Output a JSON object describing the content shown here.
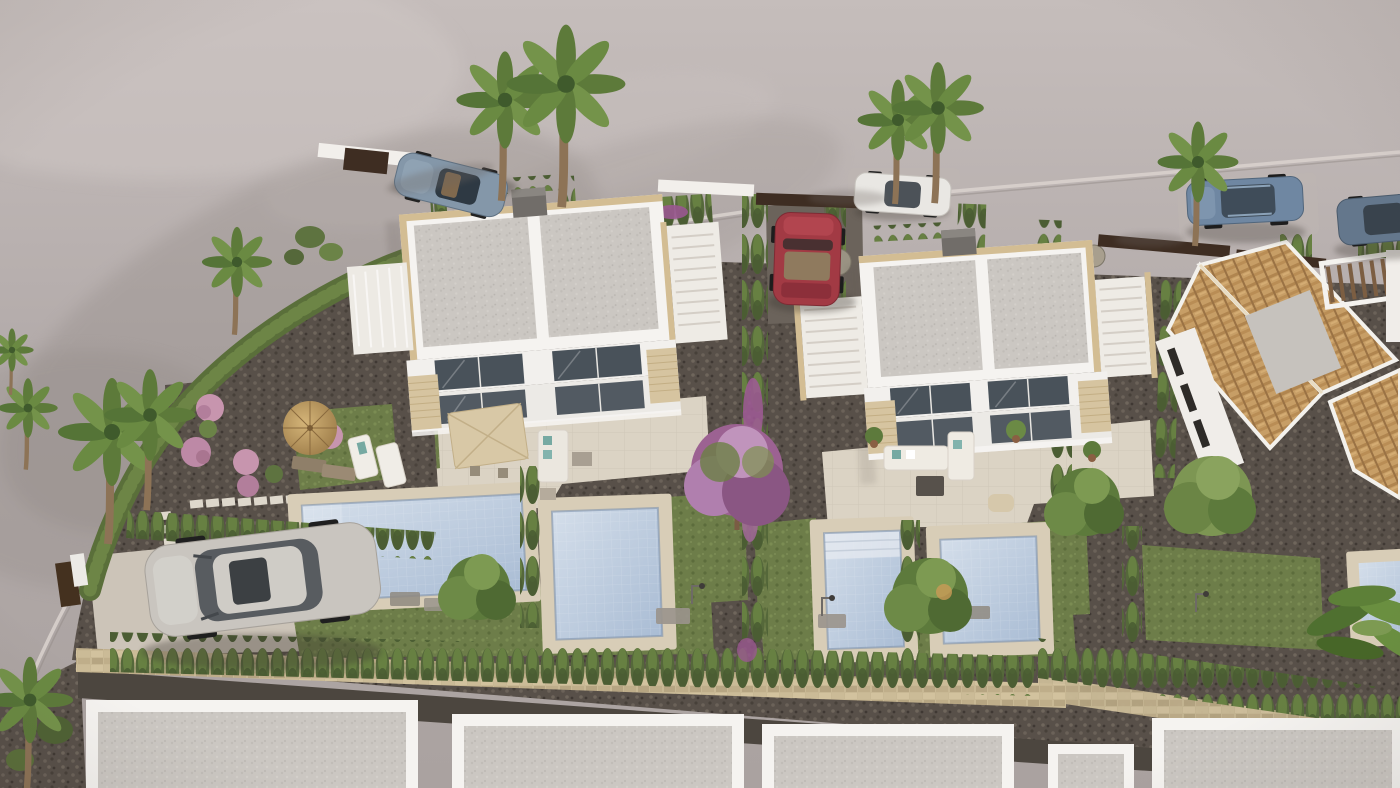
{
  "scene": {
    "type": "3d-architectural-render",
    "view": "high oblique aerial view",
    "subject": "new-build residential development: two semi-detached white villas with private pools and landscaped gardens, existing terracotta-roof villas to the east, row of white flat-roof houses along the bottom",
    "lighting": "bright daylight, soft shadows cast toward lower-left"
  },
  "palette": {
    "ground": "#b1a9a7",
    "ground_light": "#c7bfbd",
    "terrain_shadow": "#8e8682",
    "curb": "#d8d0cc",
    "gravel": "#585049",
    "driveway": "#ccc4b8",
    "patio": "#dbd3c4",
    "pool_deck": "#d8cdb7",
    "water_light": "#d4deea",
    "water_deep": "#a9bcd4",
    "lawn": "#6d7d49",
    "hedge": "#55683a",
    "hedge_light": "#678042",
    "villa_wall": "#f5f3f0",
    "roof_gray": "#cbc7c2",
    "coping_tan": "#d3bd93",
    "stone_clad": "#d6c4a0",
    "window_glass": "#49525a",
    "chimney": "#716d69",
    "stone_wall": "#c8b894",
    "rear_road": "#4c463f",
    "terracotta": "#c79e66",
    "terracotta_dark": "#9a7244",
    "flat_roof_gray": "#c6c2bd",
    "fence_brown": "#3e2d22",
    "pergola_wood": "#7c5e42",
    "parasol_canvas": "#d8c8a6",
    "thatch": "#c2a268",
    "cushion_teal": "#76a9a2",
    "bougainvillea": "#a05a96",
    "tree_pink": "#9c6292",
    "tree_green": "#5d7a3c",
    "palm_trunk": "#8d7356",
    "car_sports": "#8497a9",
    "car_white": "#e9e7e3",
    "car_red": "#a23a44",
    "car_suv_blue": "#6f87a2",
    "car_sedan_blue": "#64778c",
    "car_suv_silver": "#c9c5bf"
  },
  "inventory": {
    "new_villas": [
      {
        "name": "west-villa",
        "features": [
          "flat gray roof in two panels",
          "tan coping",
          "rooftop stair terrace",
          "two glazed floors",
          "beige patio",
          "square canvas parasol",
          "thatch parasol",
          "two pools",
          "flower garden",
          "gravel driveway with silver SUV"
        ]
      },
      {
        "name": "east-villa",
        "features": [
          "flat gray roof in two panels",
          "rooftop stair terraces",
          "two glazed floors",
          "white outdoor lounge set",
          "two pools",
          "lawns",
          "red convertible in driveway"
        ]
      }
    ],
    "pools_visible": 5,
    "vehicles": [
      {
        "type": "sports convertible",
        "color": "silver-blue",
        "location": "street top-left"
      },
      {
        "type": "compact car",
        "color": "white",
        "location": "street top-center behind palms"
      },
      {
        "type": "convertible",
        "color": "red",
        "location": "driveway between hedges"
      },
      {
        "type": "estate SUV",
        "color": "steel blue",
        "location": "street top-right"
      },
      {
        "type": "sedan",
        "color": "gray-blue",
        "location": "street far right edge"
      },
      {
        "type": "crossover SUV",
        "color": "silver",
        "location": "gravel driveway lower-left"
      }
    ],
    "vegetation": [
      "fan palms",
      "cypress hedge rows",
      "bougainvillea",
      "pink flowering shrubs",
      "banana plants",
      "ornamental trees",
      "lawns"
    ],
    "hardscape": [
      "curving street",
      "stepping-stone path",
      "rubble stone wall",
      "rear service road",
      "beige paver patios"
    ]
  }
}
